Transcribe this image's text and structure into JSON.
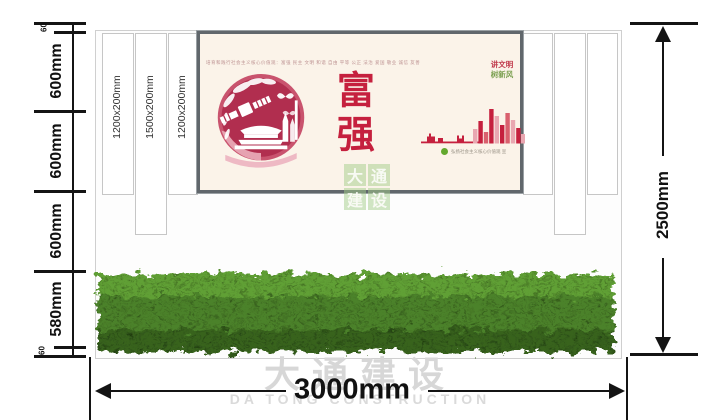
{
  "drawing": {
    "left_dimensions": [
      "60",
      "600mm",
      "600mm",
      "600mm",
      "580mm",
      "60"
    ],
    "height_total": "2500mm",
    "width_total": "3000mm",
    "post_labels": [
      "1200x200mm",
      "1500x200mm",
      "1200x200mm"
    ]
  },
  "poster": {
    "tagline": "培育和践行社会主义核心价值观：富强 民主 文明 和谐 自由 平等 公正 法治 爱国 敬业 诚信 友善",
    "main_chars": {
      "c1": "富",
      "c2": "强"
    },
    "slogan_top": "讲文明",
    "slogan_bottom": "树新风",
    "credit": "弘扬社会主义核心价值观 宣"
  },
  "watermark": {
    "cn": "大通建设",
    "en": "DA TONG CONSTRUCTION",
    "grid": [
      "大",
      "通",
      "建",
      "设"
    ]
  },
  "colors": {
    "poster_red": "#c5203e",
    "slogan_green": "#7a9f4f",
    "poster_bg": "#fbf3e9",
    "hedge_green": "#4c822a",
    "frame_gray": "#61676c"
  }
}
